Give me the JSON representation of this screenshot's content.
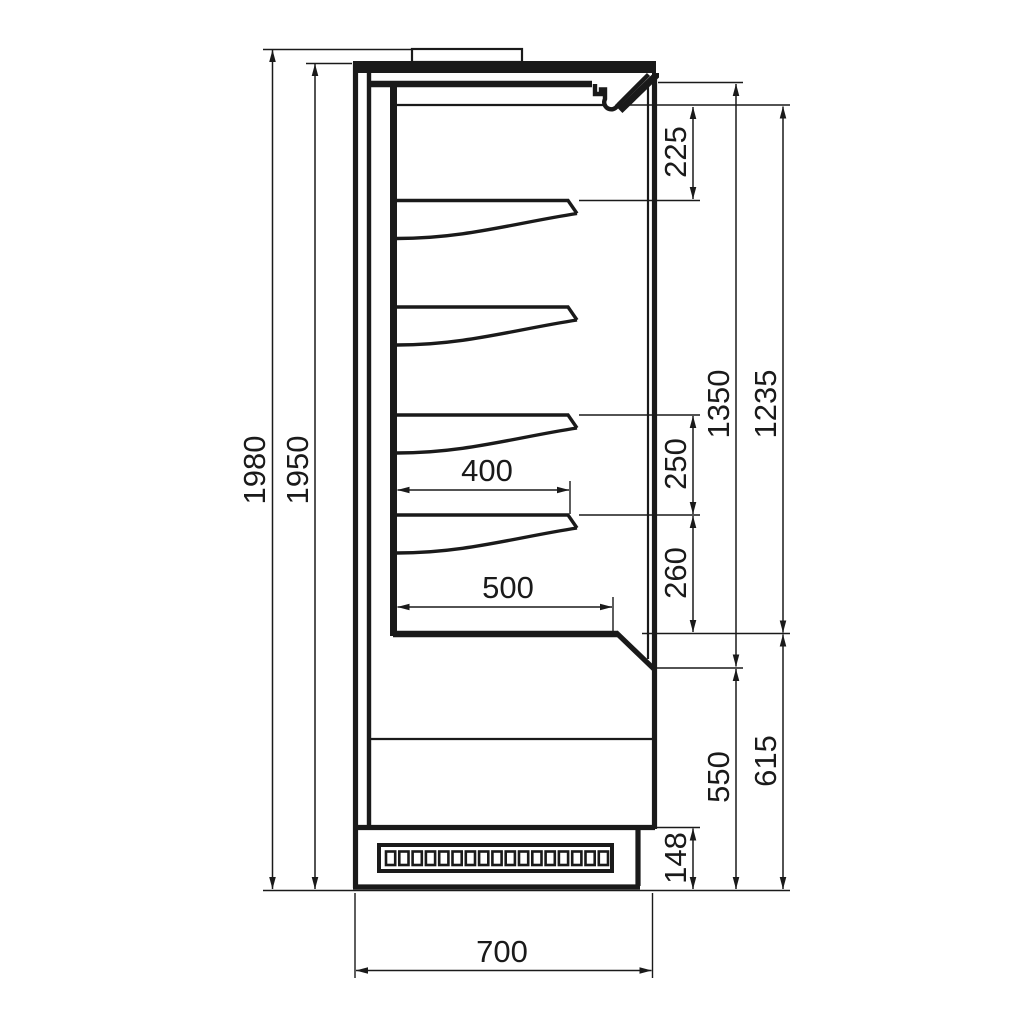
{
  "drawing": {
    "title": "refrigerated-display-cabinet-side-section",
    "units": "mm",
    "line_color": "#1a1a1a",
    "background": "#ffffff"
  },
  "dimensions": {
    "overall_height": "1980",
    "body_height": "1950",
    "top_opening": "225",
    "display_opening_total": "1350",
    "display_opening_inner": "1235",
    "shelf_gap_upper": "250",
    "shelf_gap_lower": "260",
    "shelf_depth": "400",
    "deck_depth": "500",
    "base_front_height": "550",
    "base_section_height": "615",
    "plinth_height": "148",
    "overall_depth": "700"
  },
  "parts": {
    "shelf_count": 4,
    "grille_slot_count": 17
  }
}
